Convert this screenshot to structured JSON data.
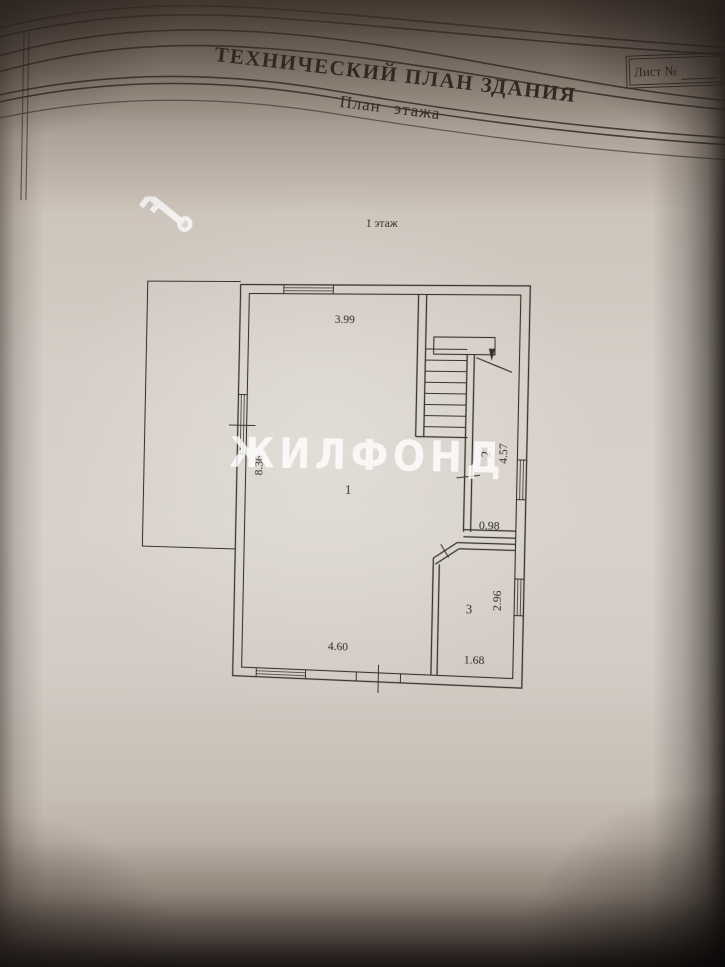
{
  "document": {
    "title": "ТЕХНИЧЕСКИЙ ПЛАН ЗДАНИЯ",
    "subtitle": "План этажа",
    "sheet_label": "Лист №"
  },
  "plan": {
    "floor_label": "1 этаж",
    "room_labels": {
      "room1": "1",
      "room2": "2",
      "room3": "3"
    },
    "dimensions": {
      "top_wall": "3.99",
      "left_wall": "8.36",
      "stair_corridor": "4.57",
      "passage": "0.98",
      "right_lower": "2.96",
      "bottom_wall": "4.60",
      "bottom_right": "1.68"
    }
  },
  "watermark": {
    "text": "ЖИЛФОНД"
  },
  "colors": {
    "ink": "#38332d",
    "paper": "#d5cec6",
    "watermark": "#ffffff"
  }
}
